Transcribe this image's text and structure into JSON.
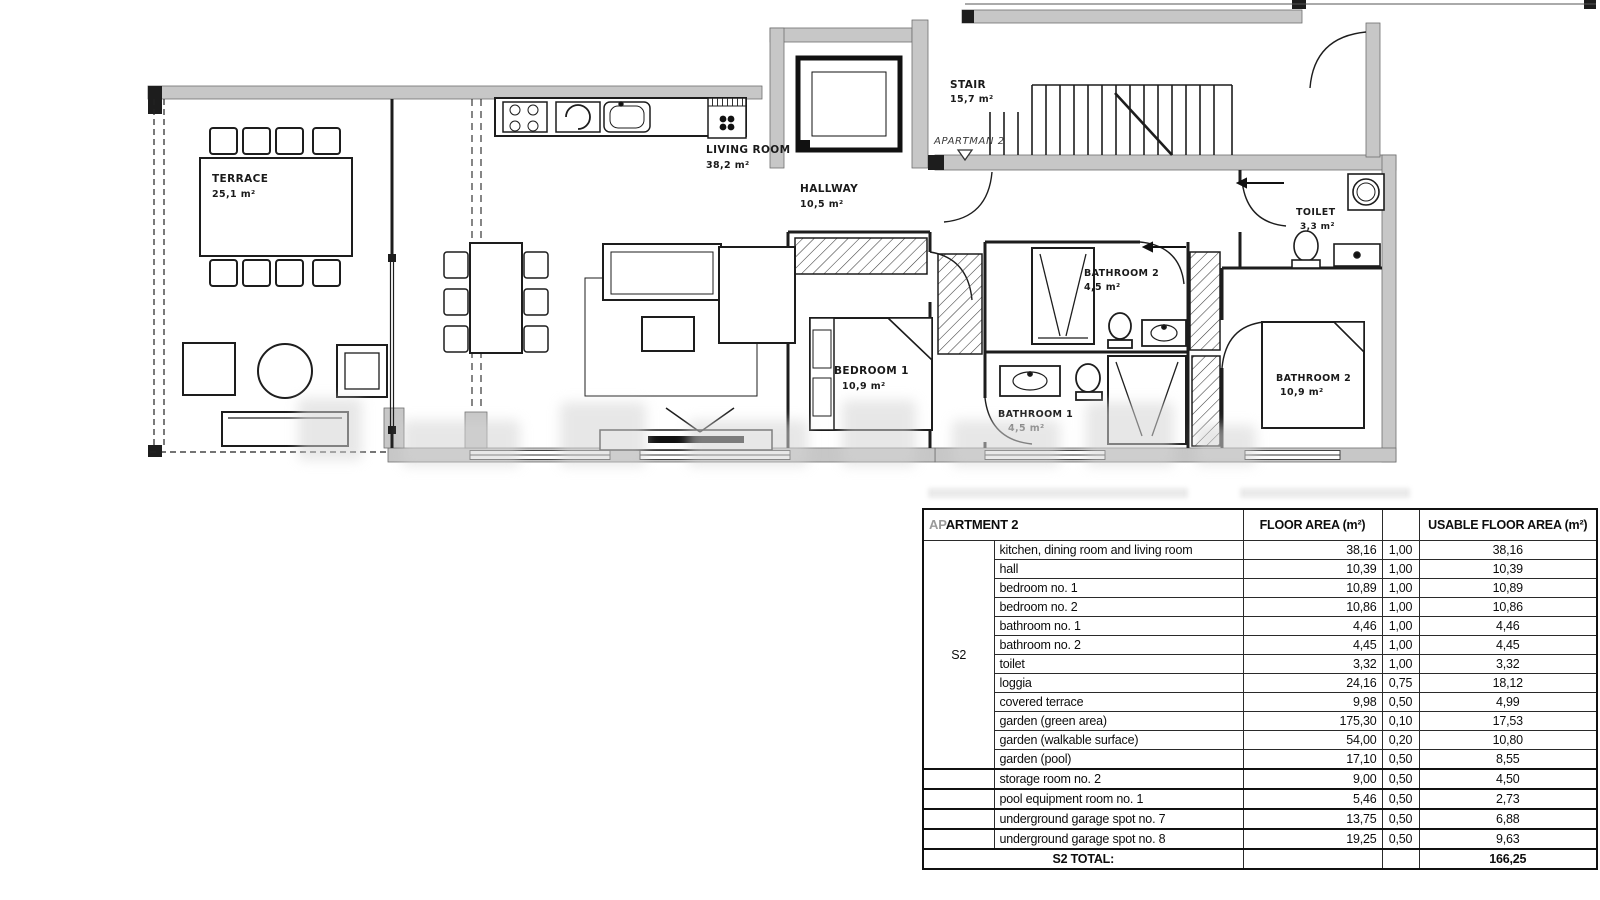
{
  "plan": {
    "rooms": {
      "terrace": {
        "name": "TERRACE",
        "area": "25,1 m²"
      },
      "living": {
        "name": "LIVING ROOM",
        "area": "38,2 m²"
      },
      "hallway": {
        "name": "HALLWAY",
        "area": "10,5 m²"
      },
      "stair": {
        "name": "STAIR",
        "area": "15,7 m²"
      },
      "entrance": {
        "name": "APARTMAN 2"
      },
      "bedroom1": {
        "name": "BEDROOM 1",
        "area": "10,9 m²"
      },
      "bathroom2s": {
        "name": "BATHROOM 2",
        "area": "4,5 m²"
      },
      "bathroom1": {
        "name": "BATHROOM 1",
        "area": "4,5 m²"
      },
      "toilet": {
        "name": "TOILET",
        "area": "3,3 m²"
      },
      "bedroom2": {
        "name": "BATHROOM 2",
        "area": "10,9 m²"
      }
    }
  },
  "table": {
    "title_prefix": "AP",
    "title_rest": "ARTMENT 2",
    "col_floor": "FLOOR AREA (m²)",
    "col_usable": "USABLE FLOOR AREA (m²)",
    "group": "S2",
    "rows": [
      [
        "kitchen, dining room and living room",
        "38,16",
        "1,00",
        "38,16"
      ],
      [
        "hall",
        "10,39",
        "1,00",
        "10,39"
      ],
      [
        "bedroom no. 1",
        "10,89",
        "1,00",
        "10,89"
      ],
      [
        "bedroom no. 2",
        "10,86",
        "1,00",
        "10,86"
      ],
      [
        "bathroom no. 1",
        "4,46",
        "1,00",
        "4,46"
      ],
      [
        "bathroom no. 2",
        "4,45",
        "1,00",
        "4,45"
      ],
      [
        "toilet",
        "3,32",
        "1,00",
        "3,32"
      ],
      [
        "loggia",
        "24,16",
        "0,75",
        "18,12"
      ],
      [
        "covered terrace",
        "9,98",
        "0,50",
        "4,99"
      ],
      [
        "garden (green area)",
        "175,30",
        "0,10",
        "17,53"
      ],
      [
        "garden (walkable surface)",
        "54,00",
        "0,20",
        "10,80"
      ],
      [
        "garden (pool)",
        "17,10",
        "0,50",
        "8,55"
      ],
      [
        "storage room no. 2",
        "9,00",
        "0,50",
        "4,50"
      ],
      [
        "pool equipment room no. 1",
        "5,46",
        "0,50",
        "2,73"
      ],
      [
        "underground garage spot no. 7",
        "13,75",
        "0,50",
        "6,88"
      ],
      [
        "underground garage spot no. 8",
        "19,25",
        "0,50",
        "9,63"
      ]
    ],
    "total_label": "S2 TOTAL:",
    "total_value": "166,25"
  }
}
